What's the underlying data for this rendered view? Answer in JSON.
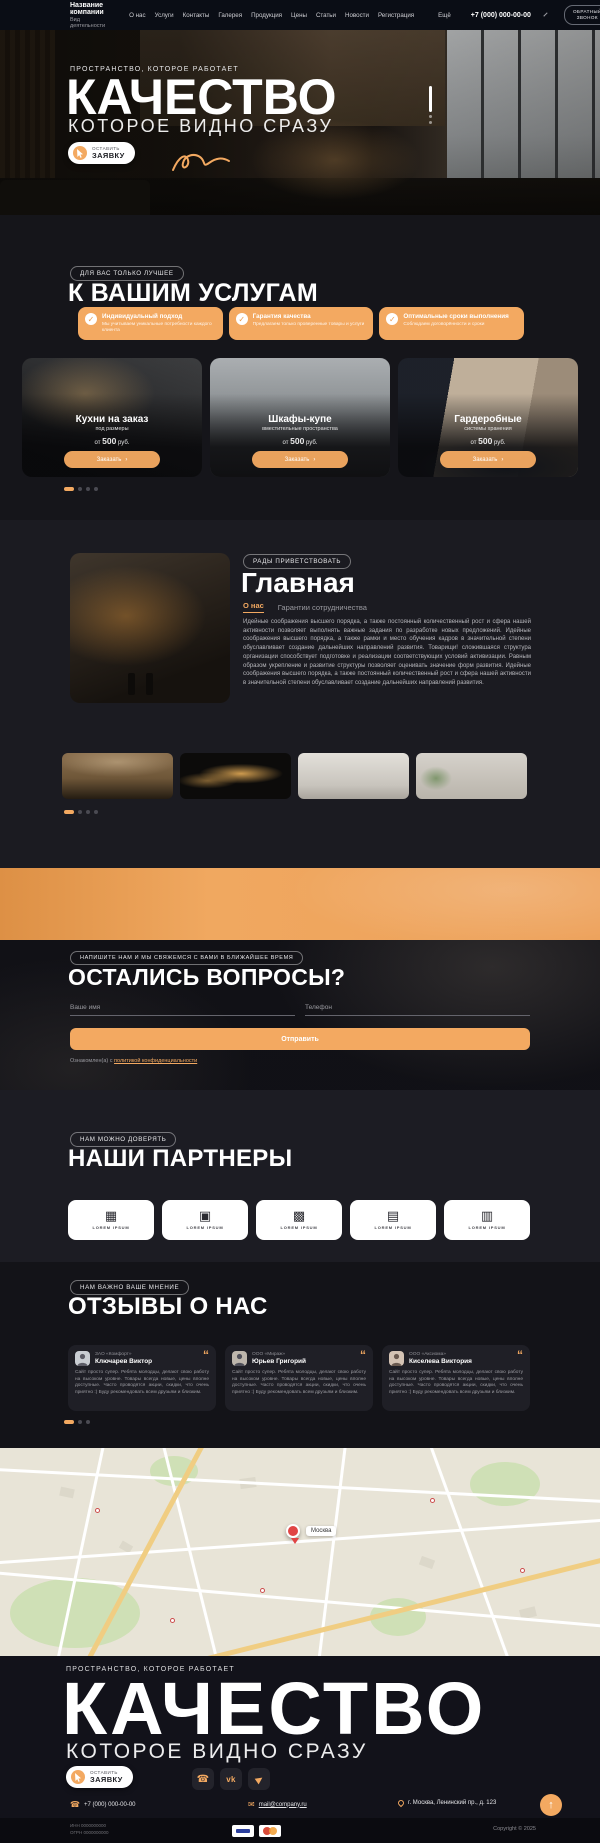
{
  "accent_color": "#f3a961",
  "header": {
    "company_name": "Название компании",
    "company_type": "Вид деятельности",
    "nav": [
      "О нас",
      "Услуги",
      "Контакты",
      "Галерея",
      "Продукция",
      "Цены",
      "Статьи",
      "Новости",
      "Регистрация"
    ],
    "more": "Ещё",
    "phone": "+7 (000) 000-00-00",
    "callback_line1": "ОБРАТНЫЙ",
    "callback_line2": "ЗВОНОК"
  },
  "hero": {
    "tagline": "ПРОСТРАНСТВО, КОТОРОЕ РАБОТАЕТ",
    "title": "КАЧЕСТВО",
    "subtitle": "КОТОРОЕ ВИДНО СРАЗУ",
    "cta_line1": "ОСТАВИТЬ",
    "cta_line2": "ЗАЯВКУ"
  },
  "services": {
    "badge": "ДЛЯ ВАС ТОЛЬКО ЛУЧШЕЕ",
    "title": "К ВАШИМ УСЛУГАМ",
    "features": [
      {
        "title": "Индивидуальный подход",
        "text": "Мы учитываем уникальные потребности каждого клиента"
      },
      {
        "title": "Гарантия качества",
        "text": "Предлагаем только проверенные товары и услуги"
      },
      {
        "title": "Оптимальные сроки выполнения",
        "text": "Соблюдаем договорённости и сроки"
      }
    ],
    "cards": [
      {
        "title": "Кухни на заказ",
        "subtitle": "под размеры",
        "price_prefix": "от",
        "price": "500",
        "price_unit": "руб.",
        "button": "Заказать",
        "arrow": "›"
      },
      {
        "title": "Шкафы-купе",
        "subtitle": "вместительные пространства",
        "price_prefix": "от",
        "price": "500",
        "price_unit": "руб.",
        "button": "Заказать",
        "arrow": "›"
      },
      {
        "title": "Гардеробные",
        "subtitle": "системы хранения",
        "price_prefix": "от",
        "price": "500",
        "price_unit": "руб.",
        "button": "Заказать",
        "arrow": "›"
      }
    ]
  },
  "about": {
    "badge": "РАДЫ ПРИВЕТСТВОВАТЬ",
    "title": "Главная",
    "tab_active": "О нас",
    "tab_inactive": "Гарантии сотрудничества",
    "paragraph": "Идейные соображения высшего порядка, а также постоянный количественный рост и сфера нашей активности позволяет выполнять важные задания по разработке новых предложений. Идейные соображения высшего порядка, а также рамки и место обучения кадров в значительной степени обуславливает создание дальнейших направлений развития. Товарищи! сложившаяся структура организации способствует подготовке и реализации соответствующих условий активизации. Равным образом укрепление и развитие структуры позволяет оценивать значение форм развития. Идейные соображения высшего порядка, а также постоянный количественный рост и сфера нашей активности в значительной степени обуславливает создание дальнейших направлений развития."
  },
  "stats": [
    {
      "value": "100%",
      "title": "ГАРАНТИЯ КАЧЕСТВА",
      "subtitle": "на все товары и услуги"
    },
    {
      "value": "98%",
      "title": "ДОВОЛЬНЫХ КЛИЕНТОВ",
      "subtitle": "по результатам опросов"
    },
    {
      "value": "785",
      "title": "ЗАКАЗОВ",
      "subtitle": "выполнены точно в срок"
    }
  ],
  "form": {
    "badge": "НАПИШИТЕ НАМ И МЫ СВЯЖЕМСЯ С ВАМИ В БЛИЖАЙШЕЕ ВРЕМЯ",
    "title": "ОСТАЛИСЬ ВОПРОСЫ?",
    "name_placeholder": "Ваше имя",
    "phone_placeholder": "Телефон",
    "submit": "Отправить",
    "consent_prefix": "Ознакомлен(а) с ",
    "consent_link": "политикой конфиденциальности"
  },
  "partners": {
    "badge": "НАМ МОЖНО ДОВЕРЯТЬ",
    "title": "НАШИ ПАРТНЕРЫ",
    "items": [
      {
        "label": "LOREM IPSUM",
        "glyph": "▦"
      },
      {
        "label": "LOREM IPSUM",
        "glyph": "▣"
      },
      {
        "label": "LOREM IPSUM",
        "glyph": "▩"
      },
      {
        "label": "LOREM IPSUM",
        "glyph": "▤"
      },
      {
        "label": "LOREM IPSUM",
        "glyph": "▥"
      }
    ]
  },
  "reviews": {
    "badge": "НАМ ВАЖНО ВАШЕ МНЕНИЕ",
    "title": "ОТЗЫВЫ О НАС",
    "items": [
      {
        "company": "ЗАО «Комфорт»",
        "name": "Ключарев Виктор",
        "text": "Сайт просто супер. Ребята молодцы, делают свою работу на высоком уровне. Товары всегда новые, цены вполне доступные. Часто проводятся акции, скидки, что очень приятно :) Буду рекомендовать всем друзьям и близким."
      },
      {
        "company": "ООО «Мираж»",
        "name": "Юрьев Григорий",
        "text": "Сайт просто супер. Ребята молодцы, делают свою работу на высоком уровне. Товары всегда новые, цены вполне доступные. Часто проводятся акции, скидки, что очень приятно :) Буду рекомендовать всем друзьям и близким."
      },
      {
        "company": "ООО «Аксиома»",
        "name": "Киселева Виктория",
        "text": "Сайт просто супер. Ребята молодцы, делают свою работу на высоком уровне. Товары всегда новые, цены вполне доступные. Часто проводятся акции, скидки, что очень приятно :) Буду рекомендовать всем друзьям и близким."
      }
    ]
  },
  "map": {
    "city": "Москва"
  },
  "footer": {
    "tagline": "ПРОСТРАНСТВО, КОТОРОЕ РАБОТАЕТ",
    "title": "КАЧЕСТВО",
    "subtitle": "КОТОРОЕ ВИДНО СРАЗУ",
    "cta_line1": "ОСТАВИТЬ",
    "cta_line2": "ЗАЯВКУ",
    "vk_label": "vk",
    "phone": "+7 (000) 000-00-00",
    "email": "mail@company.ru",
    "address": "г. Москва, Ленинский пр., д. 123"
  },
  "bottom": {
    "inn": "ИНН 0000000000",
    "ogrn": "ОГРН 0000000000",
    "copyright": "Copyright © 2025"
  }
}
